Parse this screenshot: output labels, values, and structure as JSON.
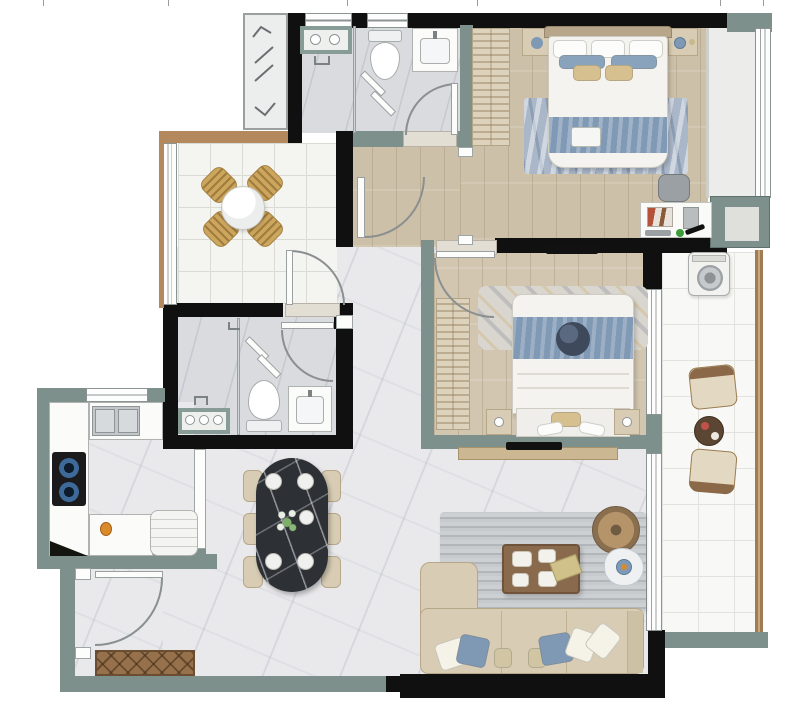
{
  "title": "two-bedroom-apartment-floor-plan",
  "canvas": {
    "width": 800,
    "height": 715
  },
  "palette": {
    "wall": "#101010",
    "partition": "#7d908b",
    "wood-tan": "#b3885c",
    "floor-wood": "#cdc0a8",
    "floor-marble": "#e9e9ec",
    "floor-bath": "#d9dbdf",
    "floor-tile": "#f4f4f1",
    "accent-blue": "#8099b4",
    "dark-navy": "#3e4a5c",
    "beige": "#d8cdb4",
    "rattan": "#cda65e",
    "table-marble": "#2d3136",
    "wood-brown": "#8a6a4c",
    "railing": "#a07c54",
    "counter-sage": "#879c96"
  },
  "rooms": [
    {
      "id": "dining-nook",
      "furniture": [
        "round-table",
        "rattan-chair x4"
      ],
      "floor": "white-tile"
    },
    {
      "id": "bathroom-1",
      "furniture": [
        "toilet",
        "washbasin",
        "glass-shower",
        "laundry-counter"
      ],
      "floor": "grey-marble"
    },
    {
      "id": "master-bedroom",
      "furniture": [
        "double-bed",
        "wardrobe",
        "nightstand x2",
        "rug",
        "desk",
        "ottoman"
      ],
      "floor": "wood"
    },
    {
      "id": "bedroom-2",
      "furniture": [
        "double-bed",
        "wardrobe",
        "nightstand x2",
        "wall-tv",
        "patterned-quilt"
      ],
      "floor": "wood"
    },
    {
      "id": "bathroom-2",
      "furniture": [
        "toilet",
        "washbasin",
        "glass-shower",
        "vanity-counter"
      ],
      "floor": "grey-marble"
    },
    {
      "id": "kitchen",
      "furniture": [
        "double-sink",
        "gas-cooktop",
        "u-counter",
        "fridge"
      ],
      "floor": "marble"
    },
    {
      "id": "dining-area",
      "furniture": [
        "oval-marble-table",
        "dining-chair x6",
        "plates x4",
        "flower-centerpiece"
      ],
      "floor": "marble"
    },
    {
      "id": "living-room",
      "furniture": [
        "l-sofa",
        "coffee-table",
        "striped-rug",
        "floor-lamp",
        "side-table",
        "tv-console"
      ],
      "floor": "marble"
    },
    {
      "id": "balcony",
      "furniture": [
        "washing-machine",
        "armchair x2",
        "tea-table"
      ],
      "floor": "white-tile"
    },
    {
      "id": "entry",
      "furniture": [
        "entrance-door",
        "doormat"
      ],
      "floor": "marble"
    }
  ],
  "openings": {
    "doors": [
      "entry-door",
      "bathroom-1-door",
      "bathroom-2-door",
      "nook-door",
      "master-door",
      "bedroom-2-door"
    ],
    "windows": [
      "bathroom-1-window x2",
      "kitchen-window",
      "master-bay-window",
      "balcony-sliders x2",
      "nook-window-wall"
    ]
  }
}
